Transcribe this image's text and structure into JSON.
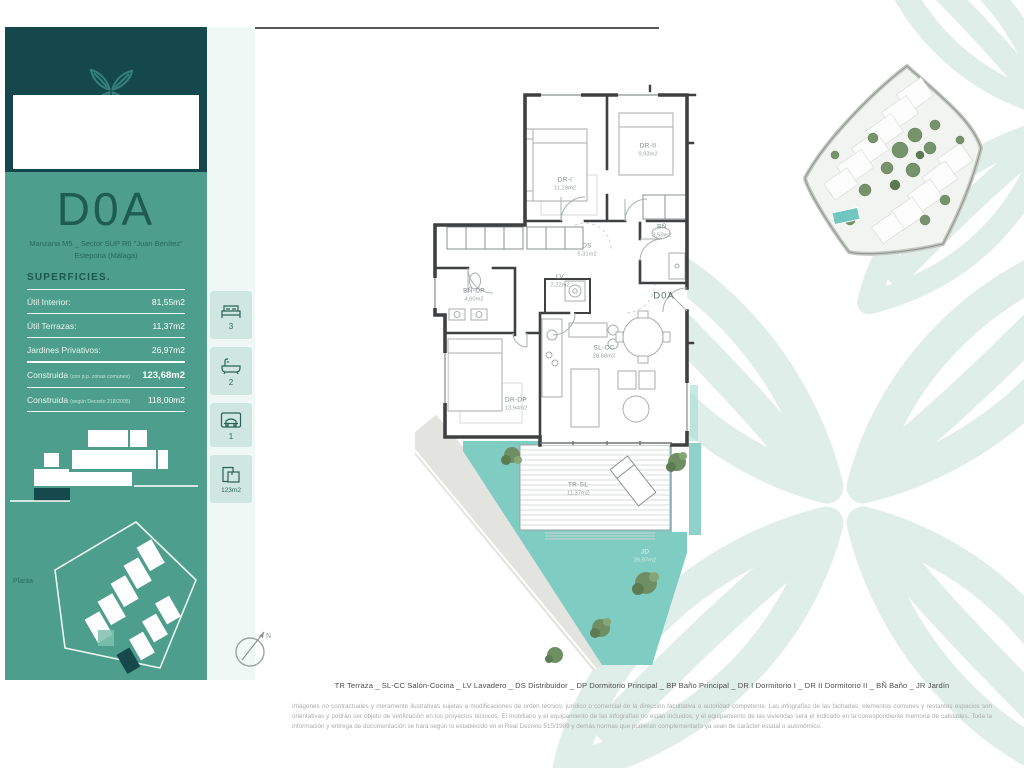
{
  "unit": {
    "code": "D0A",
    "location_line1": "Manzana M5 _ Sector SUP R6 \"Juan Benítez\"",
    "location_line2": "Estepona (Málaga)"
  },
  "superficies": {
    "title": "SUPERFICIES.",
    "rows": [
      {
        "label": "Útil Interior:",
        "value": "81,55m2"
      },
      {
        "label": "Útil Terrazas:",
        "value": "11,37m2"
      },
      {
        "label": "Jardines Privativos:",
        "value": "26,97m2"
      }
    ],
    "construida_rows": [
      {
        "label": "Construida",
        "note": "(con p.p. zonas comunes)",
        "value": "123,68m2"
      },
      {
        "label": "Construida",
        "note": "(según Decreto 218/2005)",
        "value": "118,00m2"
      }
    ]
  },
  "stats": {
    "bedrooms": "3",
    "bathrooms": "2",
    "parking": "1",
    "built_area": "123m2"
  },
  "plan_section": {
    "label": "Planta"
  },
  "floorplan": {
    "unit_label": "D0A",
    "compass": "N",
    "rooms": [
      {
        "code": "DR-I",
        "area": "11,29m2"
      },
      {
        "code": "DR-II",
        "area": "9,93m2"
      },
      {
        "code": "DS",
        "area": "5,31m2"
      },
      {
        "code": "BÑ",
        "area": "3,59m2"
      },
      {
        "code": "LV",
        "area": "2,22m2"
      },
      {
        "code": "BÑ-DP",
        "area": "4,60m2"
      },
      {
        "code": "DR-DP",
        "area": "13,94m2"
      },
      {
        "code": "SL-CC",
        "area": "28,68m2"
      },
      {
        "code": "TR-SL",
        "area": "11,37m2"
      },
      {
        "code": "JD",
        "area": "26,97m2"
      }
    ]
  },
  "footer": {
    "legend": "TR Terraza _ SL-CC Salón-Cocina _ LV Lavadero _ DS Distribuidor _ DP Dormitorio Principal _ BP Baño Principal _ DR I Dormitorio I _ DR II Dormitorio II _ BÑ Baño _ JR Jardín",
    "disclaimer": "Imágenes no contractuales y meramente ilustrativas sujetas a modificaciones de orden técnico, jurídico o comercial de la dirección facultativa o autoridad competente. Las infografías de las fachadas, elementos comunes y restantes espacios son orientativas y podrán ser objeto de verificación en los proyectos técnicos. El mobiliario y el equipamiento de las infografías no están incluidos, y el equipamiento de las viviendas será el indicado en la correspondiente memoria de calidades. Toda la información y entrega de documentación se hará según lo establecido en el Real Decreto 515/1989 y demás normas que pudieran complementarlo ya sean de carácter estatal o autonómico."
  },
  "colors": {
    "header_teal": "#14484c",
    "sidebar_green": "#4d9e8c",
    "accent_dark_teal": "#1d5b53",
    "garden_teal": "#7fccc3",
    "watermark": "#e0eeea"
  }
}
